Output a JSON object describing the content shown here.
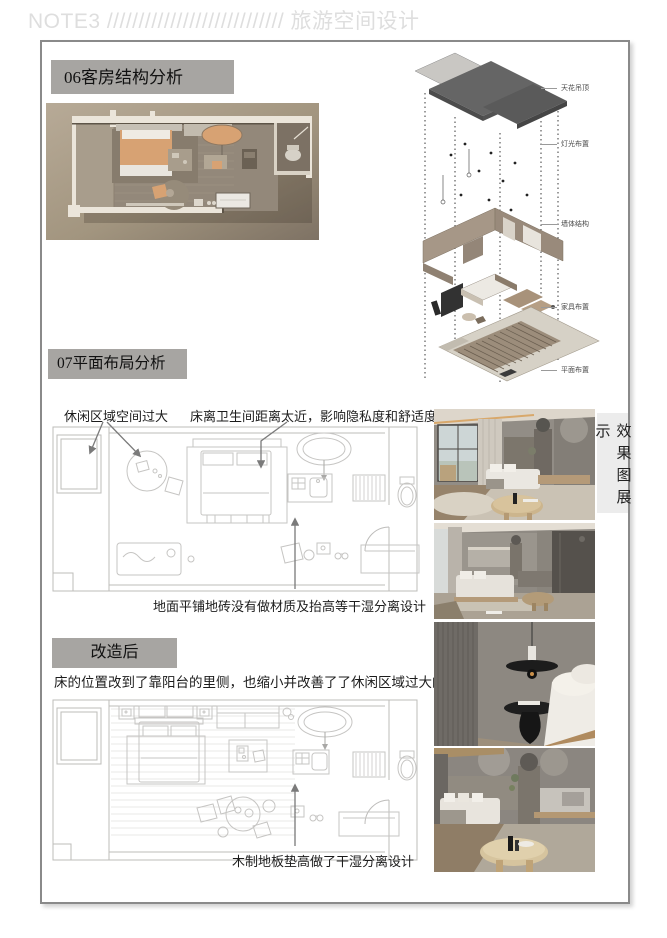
{
  "header": {
    "title": "NOTE3 //////////////////////////// 旅游空间设计"
  },
  "sections": {
    "s06": {
      "title": "06客房结构分析"
    },
    "s07": {
      "title": "07平面布局分析",
      "annotations": {
        "leisure": "休闲区域空间过大",
        "bed_bath": "床离卫生间距离太近，影响隐私度和舒适度",
        "floor_tile": "地面平铺地砖没有做材质及抬高等干湿分离设计"
      }
    },
    "after": {
      "title": "改造后",
      "desc": "床的位置改到了靠阳台的里侧，也缩小并改善了了休闲区域过大的问题",
      "annotation": "木制地板垫高做了干湿分离设计"
    },
    "gallery": {
      "label": "效果图展示"
    }
  },
  "axon_labels": [
    "天花吊顶",
    "灯光布置",
    "墙体结构",
    "家具布置",
    "平面布置"
  ],
  "colors": {
    "title_box_bg": "#a7a5a2",
    "header_text": "#dedede",
    "accent_tan": "#d7a273",
    "render_bg": "#a99c8a",
    "plan_line": "#bdbcba",
    "annotation_arrow": "#7a7a7a",
    "gallery_label_bg": "#ececec"
  }
}
